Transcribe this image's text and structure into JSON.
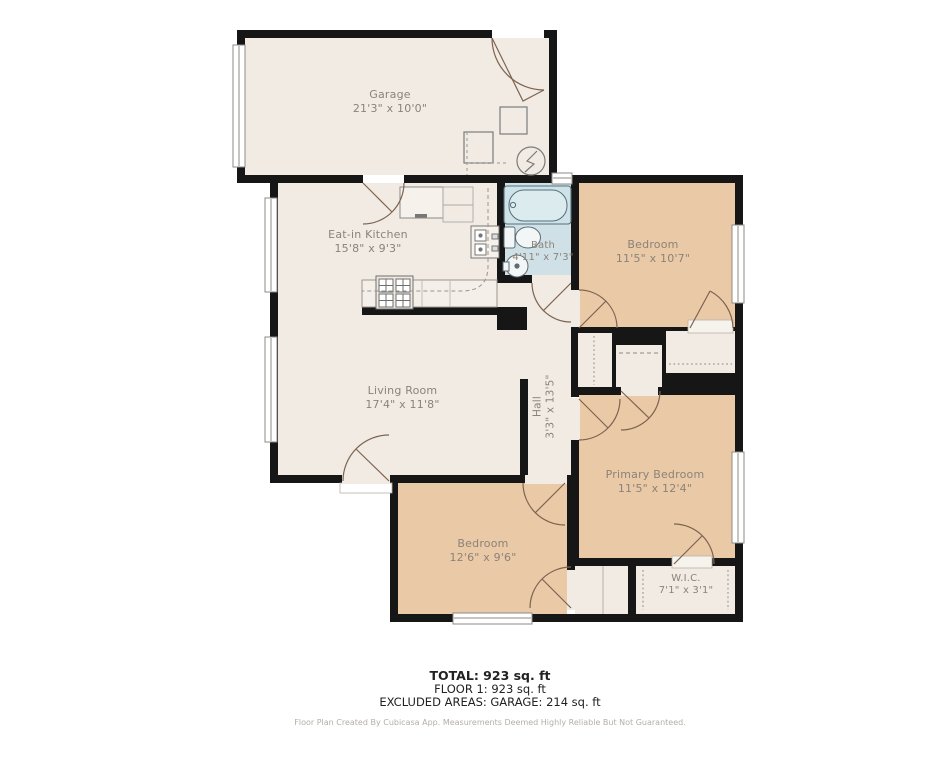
{
  "plan": {
    "rooms": {
      "garage": {
        "name": "Garage",
        "dims": "21'3\" x 10'0\""
      },
      "eat_in_kitchen": {
        "name": "Eat-in Kitchen",
        "dims": "15'8\" x 9'3\""
      },
      "bath": {
        "name": "Bath",
        "dims": "4'11\" x 7'3\""
      },
      "bedroom_top": {
        "name": "Bedroom",
        "dims": "11'5\" x 10'7\""
      },
      "living_room": {
        "name": "Living Room",
        "dims": "17'4\" x 11'8\""
      },
      "hall": {
        "name": "Hall",
        "dims": "3'3\" x 13'5\""
      },
      "primary_bedroom": {
        "name": "Primary Bedroom",
        "dims": "11'5\" x 12'4\""
      },
      "bedroom_bottom": {
        "name": "Bedroom",
        "dims": "12'6\" x 9'6\""
      },
      "wic": {
        "name": "W.I.C.",
        "dims": "7'1\" x 3'1\""
      }
    },
    "summary": {
      "total": "TOTAL: 923 sq. ft",
      "floor": "FLOOR 1: 923 sq. ft",
      "excluded": "EXCLUDED AREAS: GARAGE: 214 sq. ft",
      "disclaimer": "Floor Plan Created By Cubicasa App. Measurements Deemed Highly Reliable But Not Guaranteed."
    },
    "colors": {
      "wall": "#161616",
      "floor_light": "#f1ebe3",
      "floor_bedroom": "#eac9a6",
      "floor_bath": "#cfe1e7",
      "label_text": "#8b8379",
      "door_arc": "#7d6450"
    },
    "icons": [
      "bathtub-icon",
      "toilet-icon",
      "round-sink-icon",
      "kitchen-sink-icon",
      "stove-icon",
      "refrigerator-icon",
      "water-heater-icon",
      "window",
      "door-arc",
      "garage-door"
    ]
  }
}
